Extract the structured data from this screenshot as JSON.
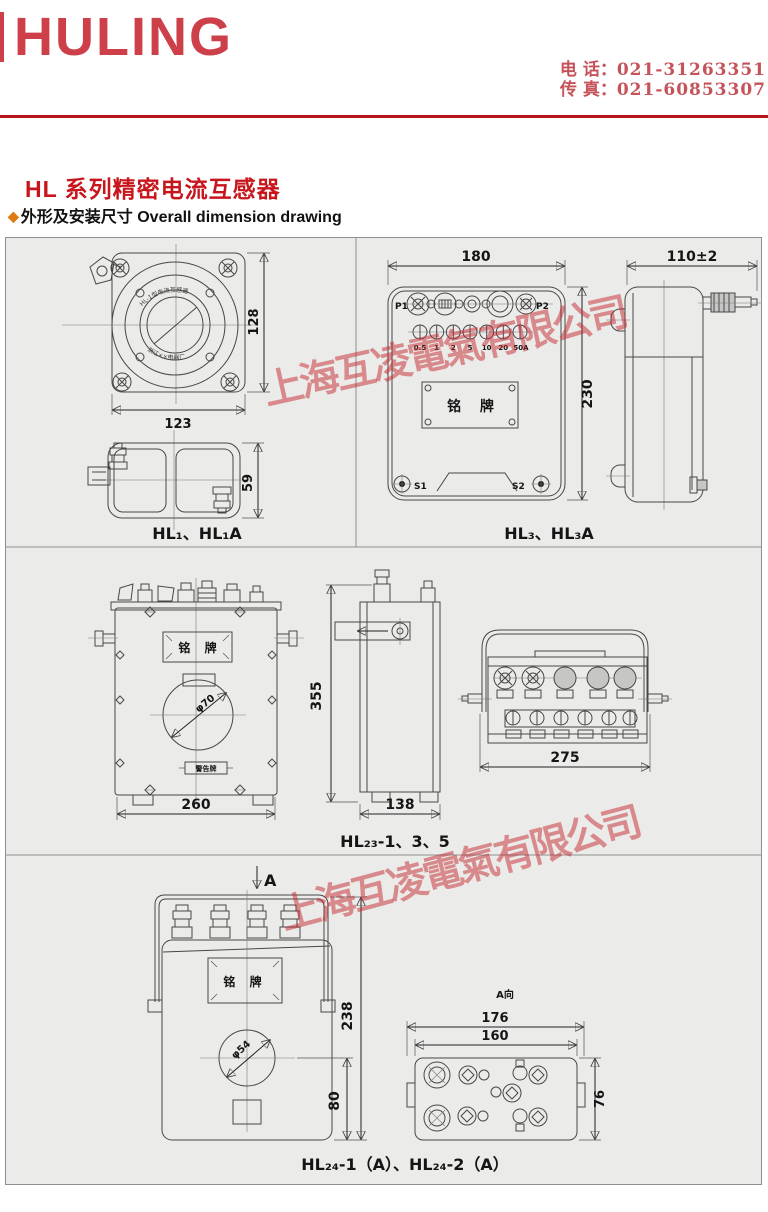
{
  "header": {
    "logo": "HULING",
    "phone_label": "电 话：",
    "phone": "021-31263351",
    "fax_label": "传 真：",
    "fax": "021-60853307"
  },
  "title": {
    "main": "HL 系列精密电流互感器",
    "diamond": "◆",
    "sub": "外形及安装尺寸 Overall dimension drawing"
  },
  "watermark": {
    "text": "上海互凌電氣有限公司",
    "color": "#c62830"
  },
  "panels": {
    "hl1": {
      "caption": "HL₁、HL₁A",
      "dim_width": "123",
      "dim_height": "128",
      "dim_side_height": "59",
      "face_top": "HL-1型电流互感器",
      "face_bottom": "浙江××电器厂"
    },
    "hl3": {
      "caption": "HL₃、HL₃A",
      "dim_width": "180",
      "dim_height": "230",
      "dim_depth": "110±2",
      "p1": "P1",
      "p2": "P2",
      "s1": "S1",
      "s2": "S2",
      "nameplate": "铭 牌",
      "taps": [
        "0.5",
        "1",
        "2",
        "5",
        "10",
        "20",
        "50A"
      ]
    },
    "hl23": {
      "caption": "HL₂₃-1、3、5",
      "dim_width": "260",
      "dim_height": "355",
      "dim_depth": "138",
      "dim_top_width": "275",
      "nameplate": "铭 牌",
      "hole": "φ70",
      "plate": "警告牌"
    },
    "hl24": {
      "caption": "HL₂₄-1（A）、HL₂₄-2（A）",
      "view_arrow": "A",
      "view_label": "A向",
      "dim_height": "238",
      "dim_hole_offset": "80",
      "hole": "φ54",
      "dim_top_outer": "176",
      "dim_top_inner": "160",
      "dim_top_height": "76",
      "nameplate": "铭 牌"
    }
  }
}
